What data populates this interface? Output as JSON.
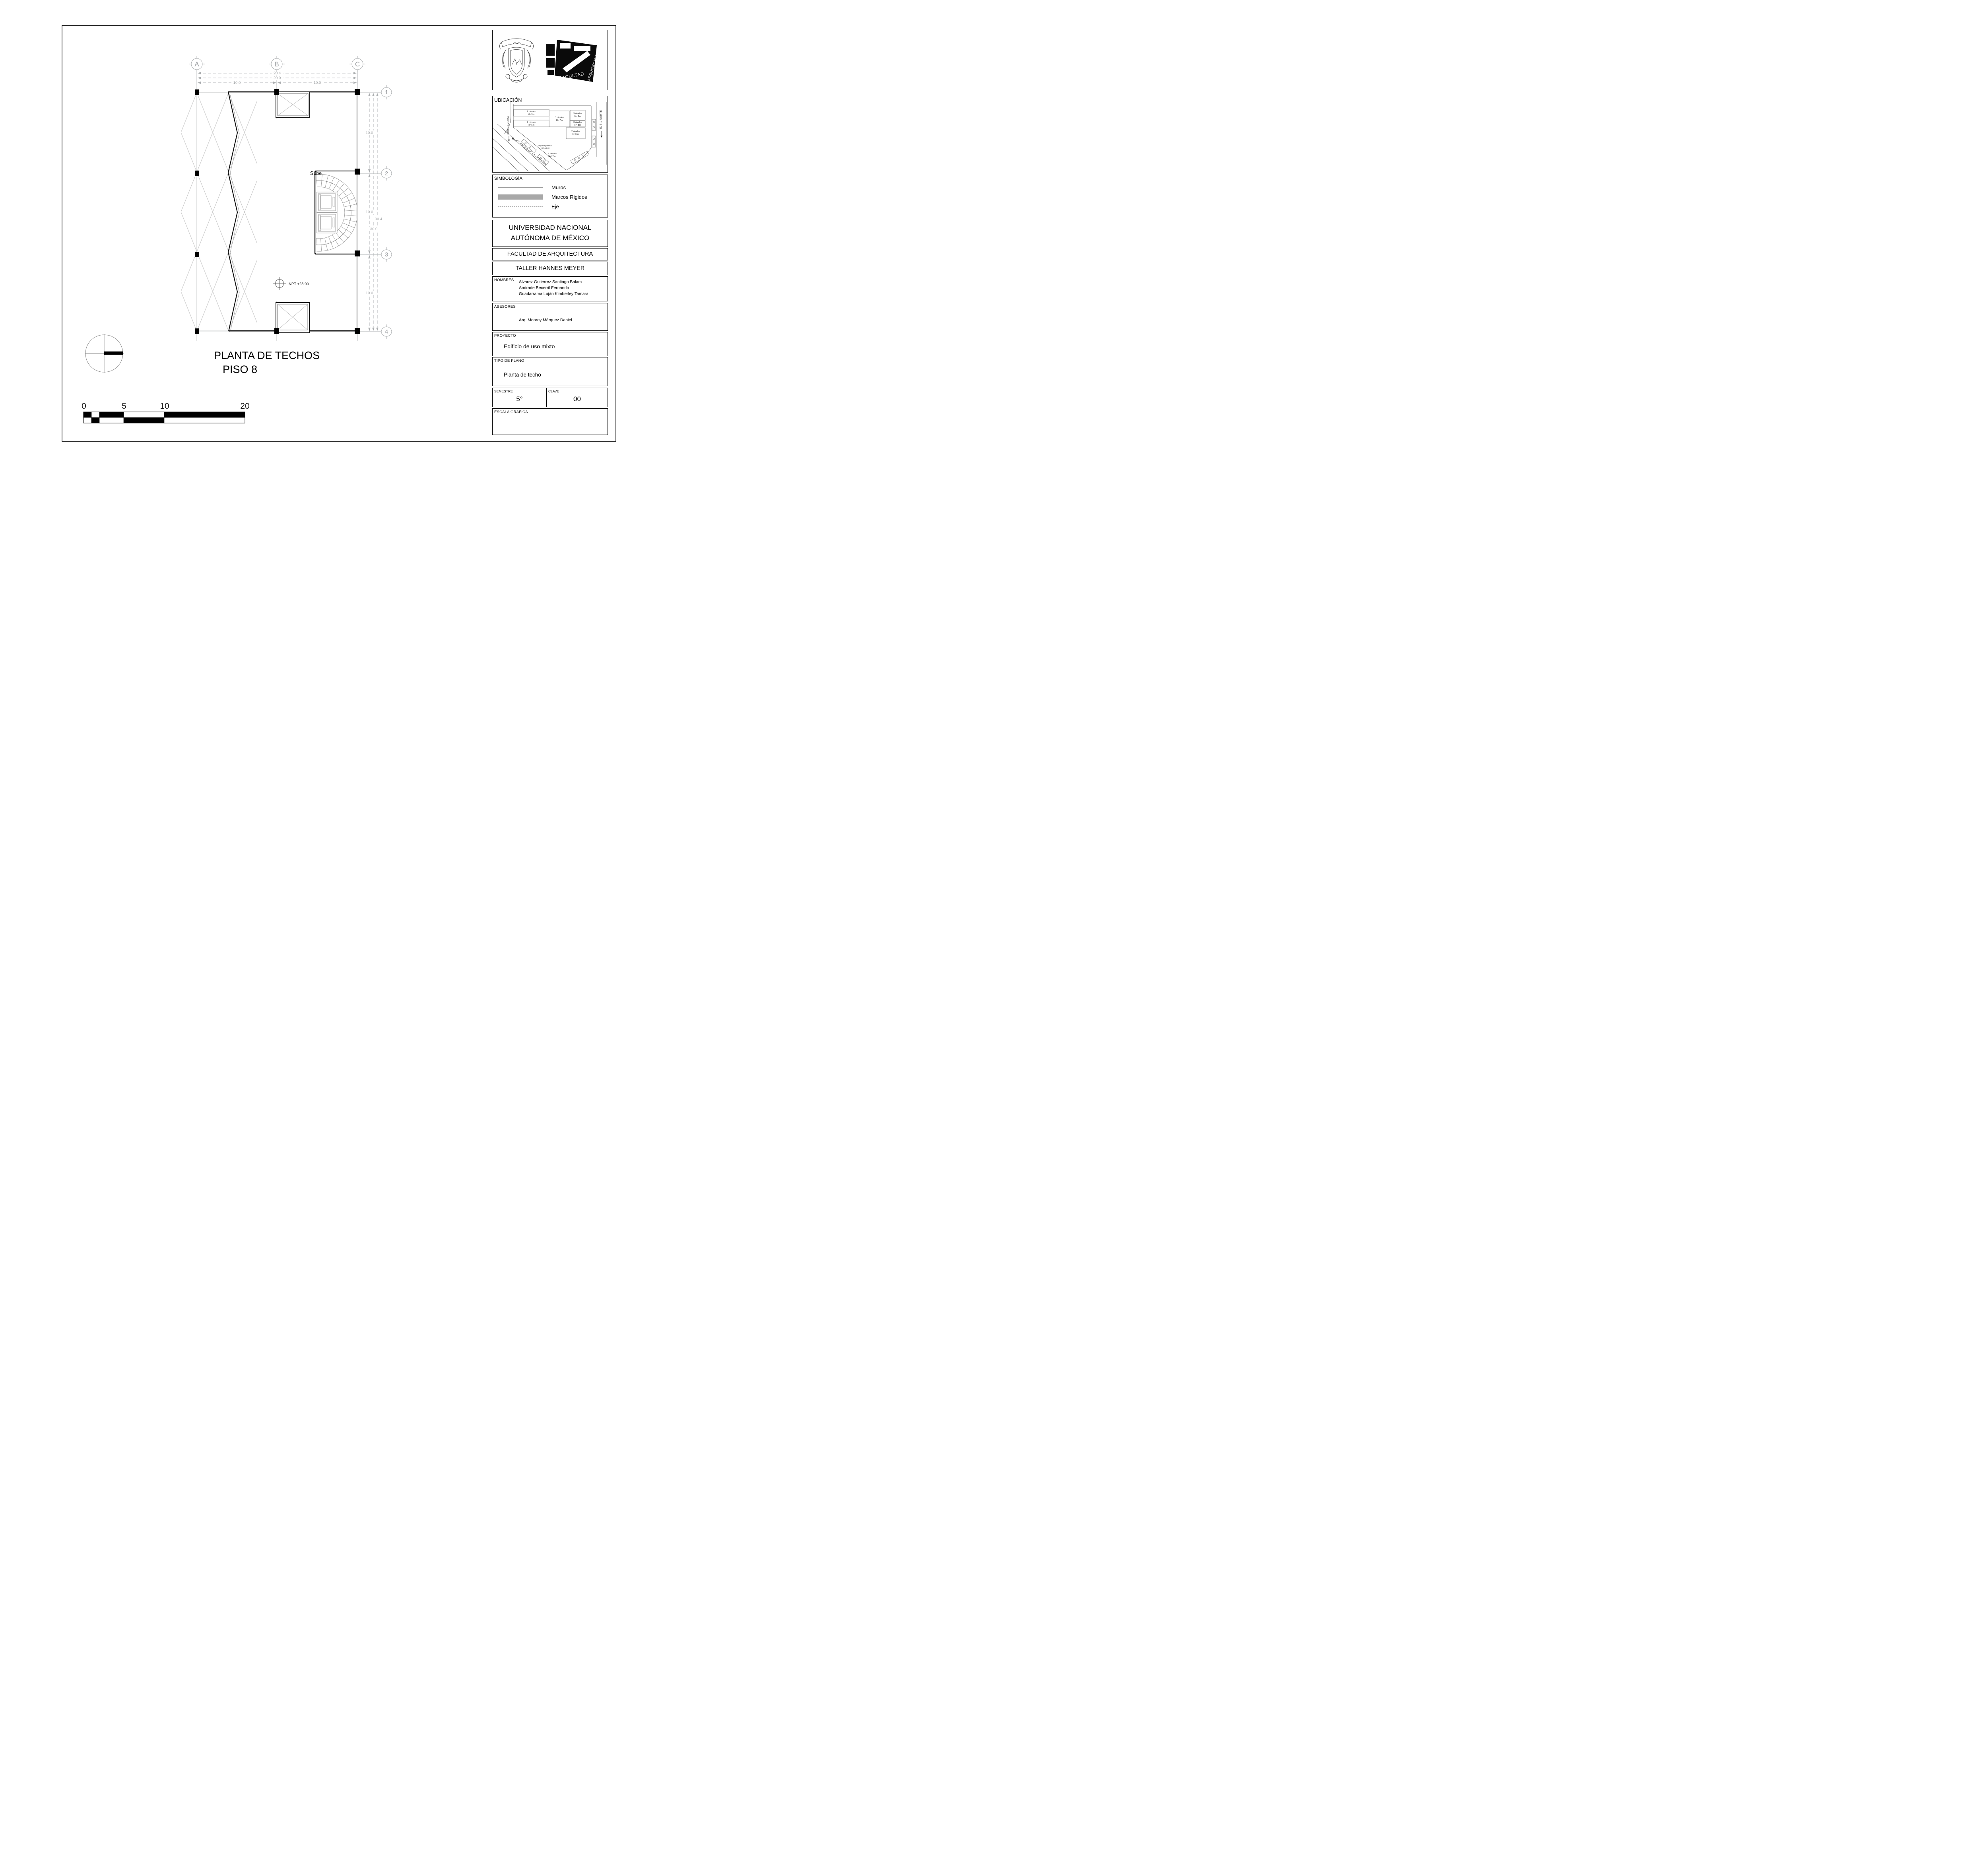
{
  "drawing": {
    "title_line1": "PLANTA DE TECHOS",
    "title_line2": "PISO 8",
    "sube": "Sube",
    "npt": "NPT +28.00",
    "grid_cols": [
      "A",
      "B",
      "C"
    ],
    "grid_rows": [
      "1",
      "2",
      "3",
      "4"
    ],
    "dims": {
      "top_total": "20.4",
      "top_wall": "20.0",
      "top_left": "10.0",
      "top_right": "10.0",
      "right_seg1": "10.0",
      "right_seg2": "10.0",
      "right_seg3": "10.0",
      "right_total": "30.0",
      "right_overall": "30.4"
    },
    "scale_bar": {
      "t0": "0",
      "t5": "5",
      "t10": "10",
      "t20": "20"
    }
  },
  "titleblock": {
    "ubicacion": {
      "title": "UBICACIÓN",
      "street_left": "MOCTEZUMA",
      "street_diag": "AV. PASEO DE LA REFORMA",
      "street_right": "EJE 1 NORTE",
      "buildings": [
        {
          "l1": "2 niveles",
          "l2": "H= 5m"
        },
        {
          "l1": "2 niveles",
          "l2": "H= 5m"
        },
        {
          "l1": "3 niveles",
          "l2": "H= 7m"
        },
        {
          "l1": "3 niveles",
          "l2": "H= 8m"
        },
        {
          "l1": "3 niveles",
          "l2": "H= 8m"
        },
        {
          "l1": "2 niveles",
          "l2": "H=6 m"
        },
        {
          "l1": "2 niveles",
          "l2": "H=7.5m"
        }
      ],
      "espacio_l1": "Espacio público",
      "espacio_l2": "B.N. ±0.00"
    },
    "simbologia": {
      "title": "SIMBOLOGÍA",
      "item_muros": "Muros",
      "item_marcos": "Marcos Rigidos",
      "item_eje": "Eje"
    },
    "universidad_l1": "UNIVERSIDAD NACIONAL",
    "universidad_l2": "AUTÓNOMA DE MÉXICO",
    "facultad": "FACULTAD DE ARQUITECTURA",
    "taller": "TALLER HANNES MEYER",
    "nombres_label": "NOMBRES",
    "nombre1": "Alvarez Gutierrez Santiago Balam",
    "nombre2": "Andrade Becerril Fernando",
    "nombre3": "Guadarrama Luján Kimberley Tamara",
    "asesores_label": "ASESORES",
    "asesor": "Arq. Monroy Márquez Daniel",
    "proyecto_label": "PROYECTO",
    "proyecto": "Edificio de uso mixto",
    "tipo_label": "TIPO DE PLANO",
    "tipo": "Planta de techo",
    "semestre_label": "SEMESTRE",
    "semestre": "5°",
    "clave_label": "CLAVE",
    "clave": "00",
    "escala_label": "ESCALA GRÁFICA",
    "fa_logo_line1": "FACULTAD",
    "fa_logo_line2": "ARQUITECTURA"
  },
  "colors": {
    "wall": "#0a0a0a",
    "grid": "#b5b8ba",
    "lattice": "#c9c9c9",
    "legend_bar": "#a8a8a8",
    "stair": "#9b9b9b"
  }
}
